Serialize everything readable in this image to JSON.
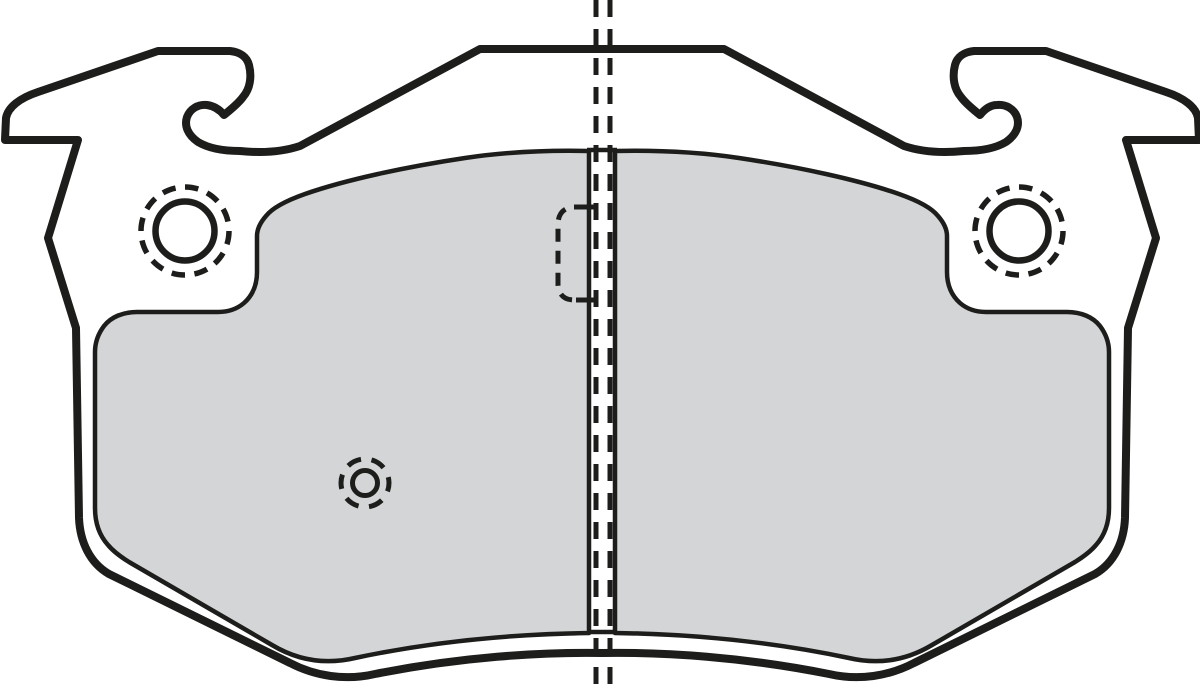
{
  "page": {
    "background": "#ffffff"
  },
  "colors": {
    "line": "#1d1d1b",
    "plate_fill": "#ffffff",
    "friction_fill": "#d3d5d6"
  },
  "drawing": {
    "type": "technical-line-drawing",
    "subject": "disc brake pad, front view",
    "parts": [
      {
        "id": "backing-plate",
        "label": "backing plate outline with hooked retaining lugs"
      },
      {
        "id": "friction-material-left",
        "label": "friction material pad, left segment (gray)"
      },
      {
        "id": "friction-material-right",
        "label": "friction material pad, right segment (gray)"
      },
      {
        "id": "guide-hole-left",
        "label": "left guide hole with dashed clearance circle"
      },
      {
        "id": "guide-hole-right",
        "label": "right guide hole with dashed clearance circle"
      },
      {
        "id": "wear-indicator",
        "label": "wear indicator hole (dashed ring)"
      },
      {
        "id": "hidden-pocket",
        "label": "hidden recess at center, shown dashed"
      },
      {
        "id": "center-line",
        "label": "double dashed vertical center line"
      }
    ]
  }
}
